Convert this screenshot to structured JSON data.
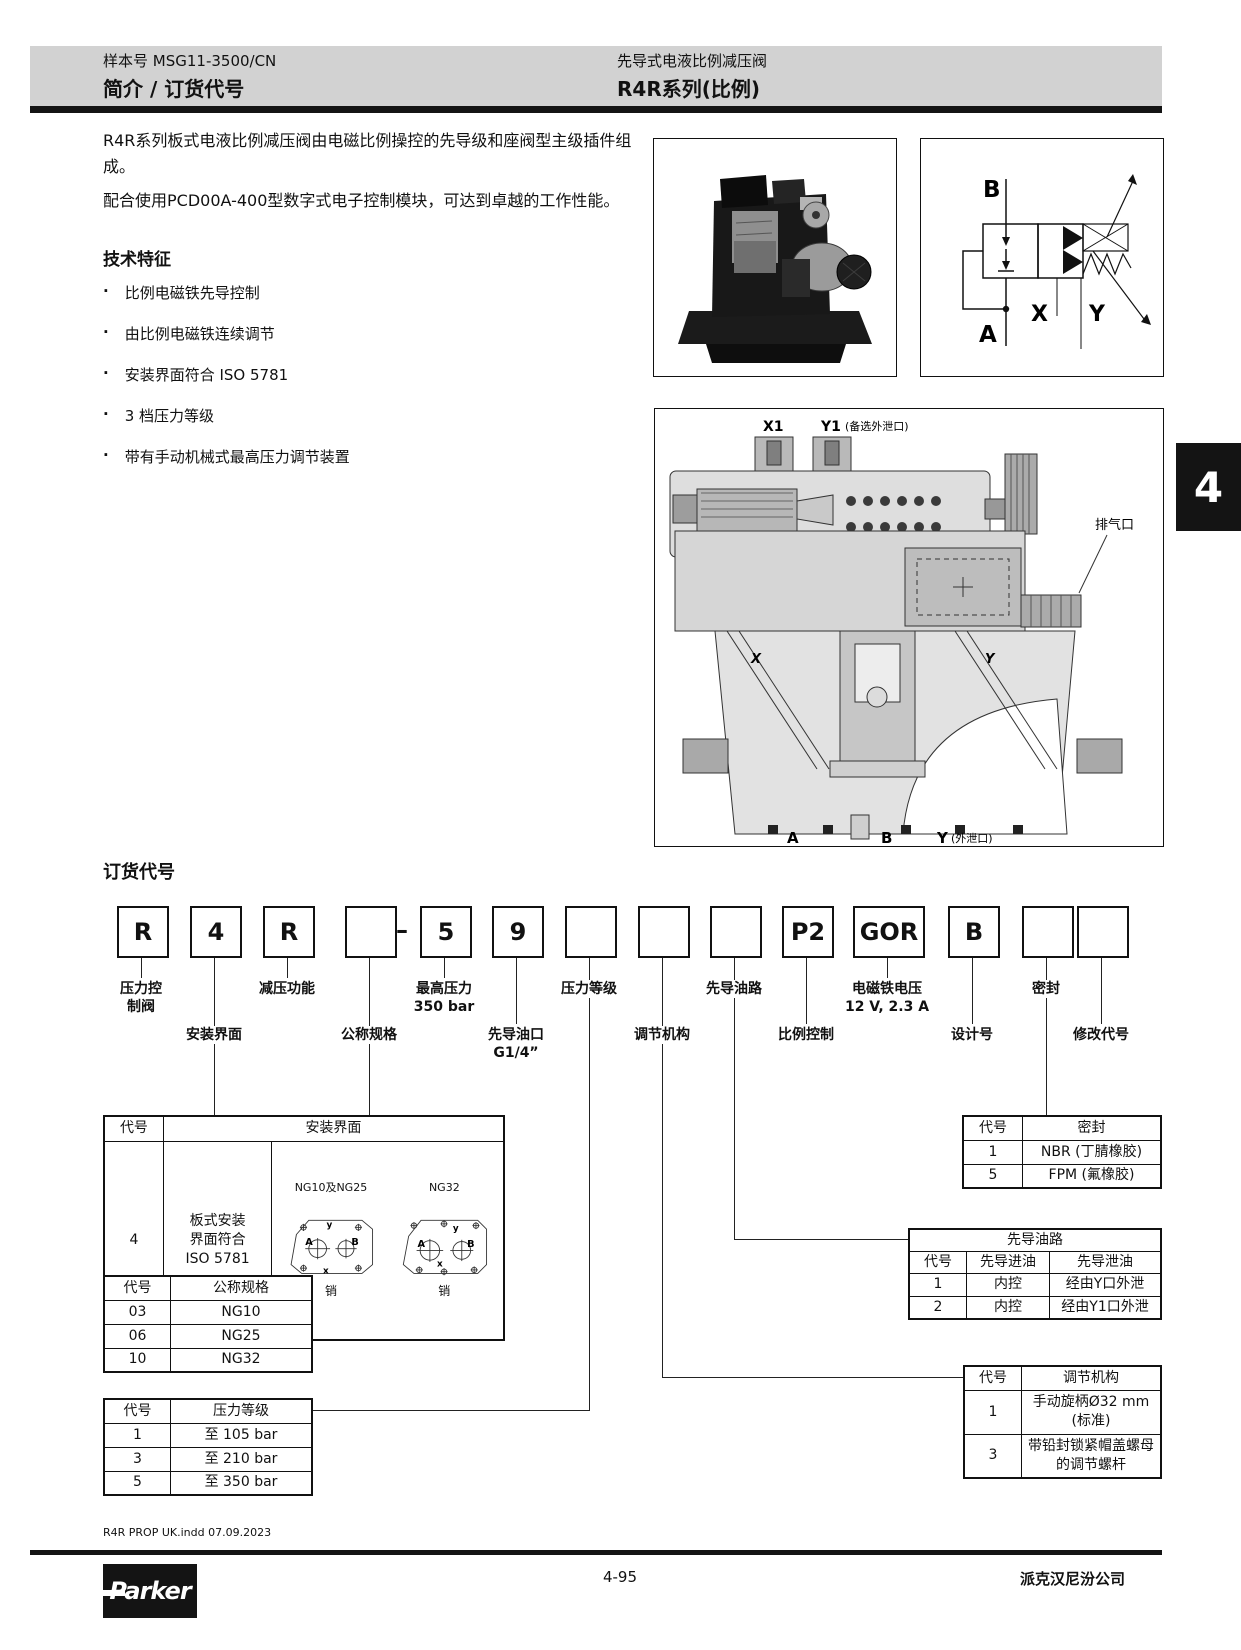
{
  "page": {
    "header": {
      "doc_number": "样本号 MSG11-3500/CN",
      "section_title": "简介 / 订货代号",
      "product_title": "先导式电液比例减压阀",
      "series_title": "R4R系列(比例)"
    },
    "side_tab": "4",
    "intro": {
      "para1": "R4R系列板式电液比例减压阀由电磁比例操控的先导级和座阀型主级插件组成。",
      "para2": "配合使用PCD00A-400型数字式电子控制模块，可达到卓越的工作性能。",
      "features_heading": "技术特征",
      "features": [
        "比例电磁铁先导控制",
        "由比例电磁铁连续调节",
        "安装界面符合 ISO 5781",
        "3 档压力等级",
        "带有手动机械式最高压力调节装置"
      ]
    },
    "symbol": {
      "port_b": "B",
      "port_a": "A",
      "port_x": "X",
      "port_y": "Y"
    },
    "cross_section": {
      "x1": "X1",
      "y1": "Y1",
      "y1_note": "(备选外泄口)",
      "vent": "排气口",
      "x_channel": "X",
      "y_channel": "Y",
      "port_a": "A",
      "port_b": "B",
      "port_y": "Y",
      "y_note": "(外泄口)"
    },
    "ordering": {
      "heading": "订货代号",
      "boxes": [
        "R",
        "4",
        "R",
        "",
        "5",
        "9",
        "",
        "",
        "",
        "P2",
        "GOR",
        "B",
        "",
        ""
      ],
      "dash": "–",
      "callouts_top": [
        "压力控\n制阀",
        "减压功能",
        "最高压力\n350 bar",
        "压力等级",
        "先导油路",
        "电磁铁电压\n12 V, 2.3 A",
        "密封"
      ],
      "callouts_bottom": [
        "安装界面",
        "公称规格",
        "先导油口\nG1/4”",
        "调节机构",
        "比例控制",
        "设计号",
        "修改代号"
      ]
    },
    "tables": {
      "code_header": "代号",
      "mounting": {
        "title": "安装界面",
        "code": "4",
        "desc": "板式安装\n界面符合\nISO 5781",
        "diag1": "NG10及NG25",
        "diag2": "NG32",
        "pin": "销",
        "pa": "A",
        "pb": "B",
        "px": "x",
        "py": "y"
      },
      "size": {
        "title": "公称规格",
        "rows": [
          [
            "03",
            "NG10"
          ],
          [
            "06",
            "NG25"
          ],
          [
            "10",
            "NG32"
          ]
        ]
      },
      "pressure": {
        "title": "压力等级",
        "rows": [
          [
            "1",
            "至 105 bar"
          ],
          [
            "3",
            "至 210 bar"
          ],
          [
            "5",
            "至 350 bar"
          ]
        ]
      },
      "seal": {
        "title": "密封",
        "rows": [
          [
            "1",
            "NBR (丁腈橡胶)"
          ],
          [
            "5",
            "FPM (氟橡胶)"
          ]
        ]
      },
      "pilot": {
        "title": "先导油路",
        "col_code": "代号",
        "col_in": "先导进油",
        "col_drain": "先导泄油",
        "rows": [
          [
            "1",
            "内控",
            "经由Y口外泄"
          ],
          [
            "2",
            "内控",
            "经由Y1口外泄"
          ]
        ]
      },
      "adjust": {
        "title": "调节机构",
        "rows": [
          [
            "1",
            "手动旋柄Ø32 mm\n(标准)"
          ],
          [
            "3",
            "带铅封锁紧帽盖螺母\n的调节螺杆"
          ]
        ]
      }
    },
    "footer": {
      "file_info": "R4R PROP UK.indd 07.09.2023",
      "page_number": "4-95",
      "company": "派克汉尼汾公司",
      "logo": "Parker"
    }
  }
}
